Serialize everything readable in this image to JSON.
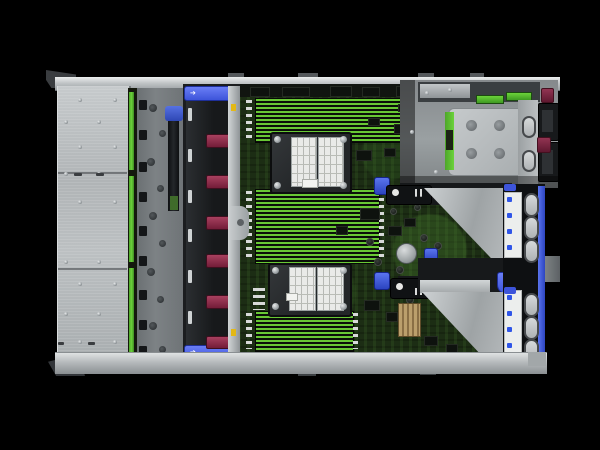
{
  "meta": {
    "description": "Top-down interior product photo of a 2U rack server with access panel removed",
    "background": "#000000"
  },
  "colors": {
    "chassis_silver": "#b6babc",
    "pcb_green": "#1c2d14",
    "dimm_stripe_green": "#68c834",
    "accent_blue": "#3d54da",
    "fan_handle_maroon": "#8e2c49",
    "backplane_green": "#5abd31",
    "label_white": "#eceeed",
    "chipset_tan": "#b79b67",
    "fan_body_black": "#1b1d1f"
  },
  "icons": {
    "latch_arrow": "➔"
  },
  "counts": {
    "fan_modules": 6,
    "cpu_heatsinks": 2,
    "dimm_banks": 3,
    "pcie_ovals": 6,
    "psu_handles": 2
  },
  "chassis": {
    "rail_tabs": [
      [
        228,
        73,
        16,
        5
      ],
      [
        298,
        73,
        20,
        5
      ],
      [
        418,
        73,
        16,
        5
      ],
      [
        470,
        73,
        14,
        5
      ]
    ],
    "foot_tabs": [
      [
        298,
        371,
        18,
        5
      ],
      [
        420,
        370,
        16,
        5
      ]
    ]
  },
  "left_plate": {
    "seams": [
      [
        58,
        172,
        69,
        2
      ],
      [
        58,
        268,
        69,
        2
      ]
    ],
    "screws": [
      [
        64,
        120,
        4,
        4
      ],
      [
        64,
        172,
        4,
        4
      ],
      [
        64,
        260,
        4,
        4
      ],
      [
        64,
        312,
        4,
        4
      ],
      [
        78,
        98,
        4,
        4
      ],
      [
        78,
        145,
        4,
        4
      ],
      [
        78,
        200,
        4,
        4
      ],
      [
        78,
        282,
        4,
        4
      ],
      [
        78,
        340,
        4,
        4
      ],
      [
        97,
        120,
        4,
        4
      ],
      [
        97,
        172,
        4,
        4
      ],
      [
        97,
        260,
        4,
        4
      ],
      [
        97,
        312,
        4,
        4
      ],
      [
        113,
        98,
        4,
        4
      ],
      [
        113,
        145,
        4,
        4
      ],
      [
        113,
        200,
        4,
        4
      ],
      [
        113,
        282,
        4,
        4
      ],
      [
        113,
        340,
        4,
        4
      ]
    ],
    "dashes": [
      [
        74,
        173,
        8,
        3
      ],
      [
        96,
        173,
        8,
        3
      ],
      [
        58,
        342,
        6,
        3
      ],
      [
        88,
        342,
        7,
        3
      ]
    ]
  },
  "backplane": {
    "segments": [
      [
        129,
        92,
        5,
        78
      ],
      [
        129,
        176,
        5,
        86
      ],
      [
        129,
        268,
        5,
        88
      ]
    ]
  },
  "bracket_zone": {
    "holes": [
      [
        149,
        104,
        8,
        8
      ],
      [
        159,
        130,
        7,
        7
      ],
      [
        147,
        158,
        8,
        8
      ],
      [
        157,
        185,
        7,
        7
      ],
      [
        149,
        212,
        8,
        8
      ],
      [
        159,
        240,
        7,
        7
      ],
      [
        147,
        268,
        8,
        8
      ],
      [
        157,
        296,
        7,
        7
      ],
      [
        149,
        322,
        8,
        8
      ],
      [
        159,
        346,
        7,
        7
      ]
    ],
    "clips": [
      [
        139,
        100,
        8,
        10
      ],
      [
        139,
        130,
        8,
        10
      ],
      [
        139,
        162,
        8,
        10
      ],
      [
        139,
        192,
        8,
        10
      ],
      [
        139,
        226,
        8,
        10
      ],
      [
        139,
        256,
        8,
        10
      ],
      [
        139,
        290,
        8,
        10
      ],
      [
        139,
        320,
        8,
        10
      ],
      [
        139,
        346,
        8,
        9
      ]
    ]
  },
  "fans": {
    "handles": [
      [
        206,
        134,
        22,
        12
      ],
      [
        206,
        175,
        22,
        12
      ],
      [
        206,
        216,
        22,
        12
      ],
      [
        206,
        254,
        22,
        12
      ],
      [
        206,
        295,
        22,
        12
      ],
      [
        206,
        336,
        22,
        11
      ]
    ],
    "ribs": [
      [
        188,
        108,
        4,
        13
      ],
      [
        188,
        149,
        4,
        13
      ],
      [
        188,
        190,
        4,
        13
      ],
      [
        188,
        229,
        4,
        13
      ],
      [
        188,
        270,
        4,
        13
      ],
      [
        188,
        311,
        4,
        13
      ]
    ],
    "ticks": [
      [
        231,
        104,
        5,
        7
      ],
      [
        231,
        329,
        5,
        7
      ]
    ]
  },
  "dimm_banks": [
    [
      255,
      98,
      152,
      43
    ],
    [
      255,
      189,
      123,
      73
    ],
    [
      255,
      311,
      97,
      39
    ]
  ],
  "dimm_latches": [
    [
      246,
      100,
      6,
      40
    ],
    [
      246,
      191,
      6,
      70
    ],
    [
      246,
      313,
      6,
      36
    ],
    [
      408,
      100,
      5,
      40
    ],
    [
      379,
      191,
      5,
      70
    ],
    [
      353,
      313,
      5,
      36
    ],
    [
      253,
      288,
      12,
      22
    ]
  ],
  "cpu_screws": [
    [
      274,
      136,
      7,
      7
    ],
    [
      340,
      136,
      7,
      7
    ],
    [
      274,
      182,
      7,
      7
    ],
    [
      340,
      182,
      7,
      7
    ],
    [
      272,
      267,
      7,
      7
    ],
    [
      340,
      267,
      7,
      7
    ],
    [
      272,
      303,
      7,
      7
    ],
    [
      340,
      303,
      7,
      7
    ]
  ],
  "pcb_parts": {
    "chips": [
      [
        356,
        150,
        14,
        9
      ],
      [
        384,
        148,
        10,
        7
      ],
      [
        360,
        208,
        18,
        10
      ],
      [
        388,
        226,
        12,
        8
      ],
      [
        404,
        218,
        10,
        7
      ],
      [
        364,
        300,
        14,
        9
      ],
      [
        386,
        312,
        10,
        8
      ],
      [
        428,
        260,
        12,
        8
      ],
      [
        394,
        124,
        12,
        8
      ],
      [
        368,
        118,
        10,
        6
      ],
      [
        398,
        104,
        8,
        6
      ],
      [
        336,
        226,
        10,
        7
      ],
      [
        424,
        336,
        12,
        8
      ],
      [
        446,
        344,
        10,
        7
      ]
    ],
    "caps": [
      [
        366,
        238,
        6,
        6
      ],
      [
        396,
        266,
        6,
        6
      ],
      [
        420,
        234,
        6,
        6
      ],
      [
        374,
        258,
        6,
        6
      ],
      [
        406,
        296,
        6,
        6
      ],
      [
        434,
        242,
        6,
        6
      ],
      [
        390,
        208,
        5,
        5
      ],
      [
        414,
        204,
        5,
        5
      ]
    ],
    "plugs": [
      [
        374,
        177,
        14,
        16
      ],
      [
        374,
        272,
        14,
        16
      ],
      [
        424,
        248,
        12,
        12
      ]
    ],
    "topstrip_blocks": [
      [
        250,
        87,
        18,
        8
      ],
      [
        282,
        87,
        26,
        8
      ],
      [
        330,
        86,
        20,
        9
      ],
      [
        362,
        87,
        16,
        8
      ],
      [
        396,
        86,
        14,
        9
      ]
    ]
  },
  "bay": {
    "green_slots": [
      [
        476,
        95,
        26,
        7
      ],
      [
        506,
        92,
        24,
        7
      ]
    ],
    "tray_holes": [
      [
        466,
        120,
        11,
        11
      ],
      [
        494,
        120,
        11,
        11
      ],
      [
        466,
        148,
        11,
        11
      ],
      [
        494,
        148,
        11,
        11
      ]
    ],
    "oval_slots": [
      [
        522,
        116,
        10,
        18
      ],
      [
        522,
        150,
        10,
        18
      ]
    ],
    "psu_handles": [
      [
        538,
        103,
        19,
        36
      ],
      [
        538,
        142,
        19,
        38
      ]
    ],
    "psu_inners": [
      [
        542,
        110,
        11,
        22
      ],
      [
        542,
        150,
        11,
        24
      ]
    ],
    "maroon_tabs": [
      [
        541,
        88,
        11,
        13
      ],
      [
        537,
        137,
        12,
        14
      ]
    ],
    "screws": [
      [
        410,
        130,
        4,
        4
      ],
      [
        434,
        170,
        4,
        4
      ],
      [
        425,
        91,
        4,
        4
      ],
      [
        448,
        88,
        4,
        4
      ]
    ]
  },
  "risers": {
    "strips": [
      [
        400,
        183,
        112,
        22
      ],
      [
        398,
        276,
        114,
        18
      ]
    ],
    "blue_labels": [
      [
        408,
        186,
        19,
        14
      ],
      [
        408,
        285,
        19,
        13
      ]
    ],
    "touch_brackets": [
      [
        386,
        185,
        44,
        18
      ],
      [
        390,
        278,
        44,
        19
      ]
    ]
  },
  "pcie_column": {
    "labels": [
      [
        504,
        192,
        16,
        64
      ],
      [
        504,
        290,
        16,
        64
      ]
    ],
    "ovals": [
      [
        524,
        193,
        11,
        20
      ],
      [
        524,
        216,
        11,
        20
      ],
      [
        524,
        239,
        11,
        20
      ],
      [
        524,
        293,
        11,
        20
      ],
      [
        524,
        316,
        11,
        20
      ],
      [
        524,
        339,
        11,
        20
      ]
    ],
    "glyphs": [
      [
        507,
        197,
        5,
        5
      ],
      [
        507,
        213,
        5,
        5
      ],
      [
        507,
        229,
        5,
        5
      ],
      [
        507,
        245,
        5,
        5
      ],
      [
        507,
        295,
        5,
        5
      ],
      [
        507,
        311,
        5,
        5
      ],
      [
        507,
        327,
        5,
        5
      ],
      [
        507,
        343,
        5,
        5
      ]
    ],
    "tabs": [
      [
        504,
        184,
        12,
        7
      ],
      [
        504,
        287,
        12,
        7
      ]
    ]
  }
}
